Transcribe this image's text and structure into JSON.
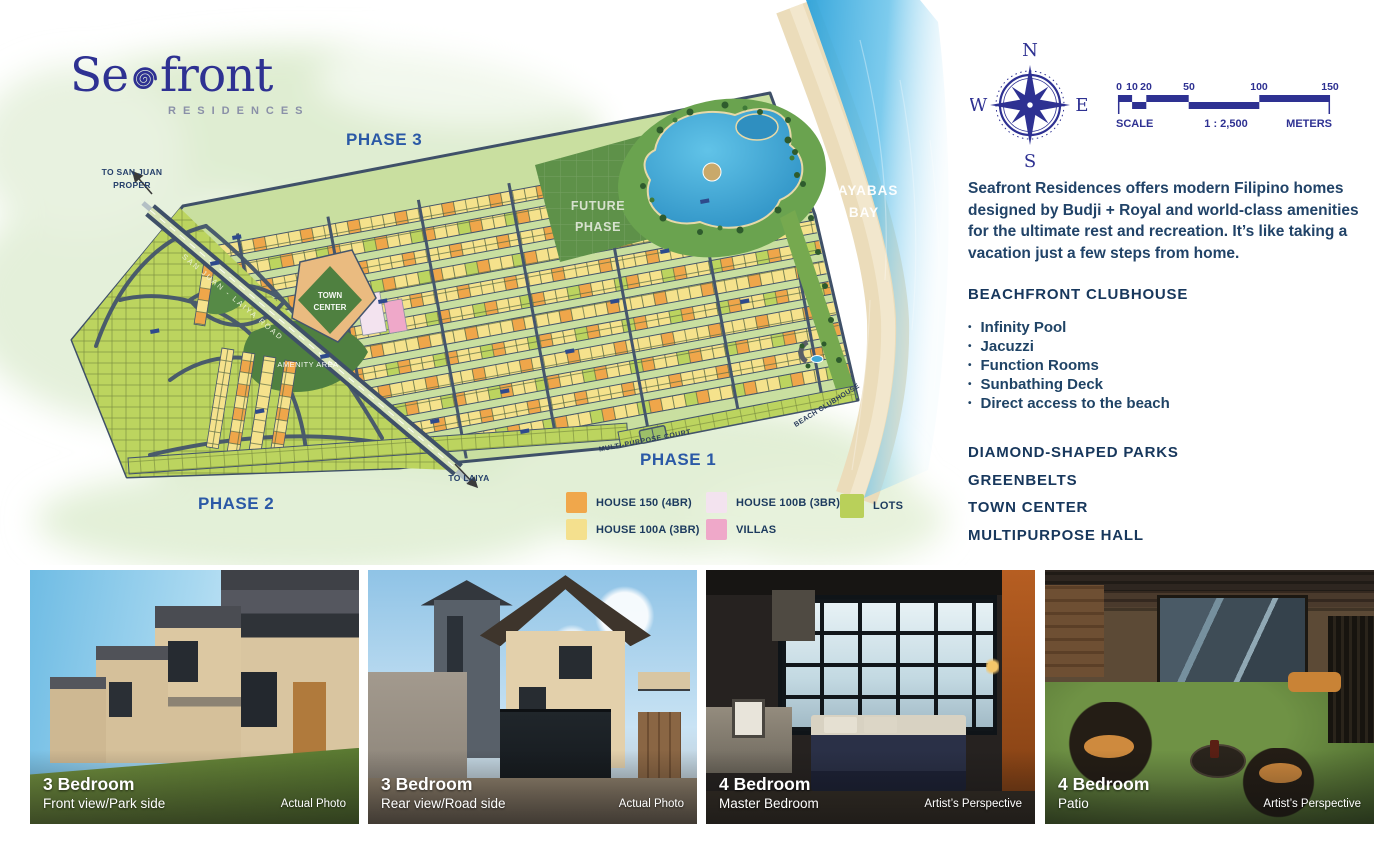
{
  "logo": {
    "se": "Se",
    "front": "front",
    "subtitle": "RESIDENCES"
  },
  "compass": {
    "n": "N",
    "e": "E",
    "s": "S",
    "w": "W"
  },
  "scale_bar": {
    "ticks": [
      "0",
      "10",
      "20",
      "50",
      "100",
      "150"
    ],
    "label_scale": "SCALE",
    "ratio": "1 : 2,500",
    "label_meters": "METERS"
  },
  "map": {
    "labels": {
      "phase1": "PHASE 1",
      "phase2": "PHASE 2",
      "phase3": "PHASE 3",
      "future_phase": "FUTURE PHASE",
      "bay": "TAYABAS BAY",
      "to_san_juan": "TO SAN JUAN PROPER",
      "to_laiya": "TO LAIYA",
      "amenity_area": "AMENITY AREA",
      "town_center": "TOWN CENTER",
      "beach_clubhouse": "BEACH CLUBHOUSE",
      "multipurpose_court": "MULTI-PURPOSE COURT",
      "main_road": "SAN JUAN - LAIYA ROAD"
    }
  },
  "legend": {
    "items": [
      {
        "label": "HOUSE 150 (4BR)",
        "color": "#F0A74B"
      },
      {
        "label": "HOUSE 100A (3BR)",
        "color": "#F4E08E"
      },
      {
        "label": "HOUSE 100B (3BR)",
        "color": "#F3E3EF"
      },
      {
        "label": "VILLAS",
        "color": "#EFA8C9"
      },
      {
        "label": "LOTS",
        "color": "#B9D05A"
      }
    ]
  },
  "sidebar": {
    "bullet": "•",
    "description": "Seafront Residences offers modern Filipino homes designed by Budji + Royal and world-class amenities for the ultimate rest and recreation. It’s like taking a vacation just a few steps from home.",
    "clubhouse_heading": "BEACHFRONT CLUBHOUSE",
    "amenities": [
      "Infinity Pool",
      "Jacuzzi",
      "Function Rooms",
      "Sunbathing Deck",
      "Direct access to the beach"
    ],
    "features": [
      "DIAMOND-SHAPED PARKS",
      "GREENBELTS",
      "TOWN CENTER",
      "MULTIPURPOSE HALL"
    ]
  },
  "photos": [
    {
      "title": "3 Bedroom",
      "subtitle": "Front view/Park side",
      "credit": "Actual Photo"
    },
    {
      "title": "3 Bedroom",
      "subtitle": "Rear view/Road side",
      "credit": "Actual Photo"
    },
    {
      "title": "4 Bedroom",
      "subtitle": "Master Bedroom",
      "credit": "Artist’s Perspective"
    },
    {
      "title": "4 Bedroom",
      "subtitle": "Patio",
      "credit": "Artist’s Perspective"
    }
  ],
  "colors": {
    "text_navy": "#1C3A5E",
    "phase_blue": "#2B59A6",
    "logo_indigo": "#2E3192",
    "water": "#3FB0E4",
    "sand": "#ECDDBB",
    "road": "#3F5068",
    "lot_green": "#B9D05A"
  }
}
